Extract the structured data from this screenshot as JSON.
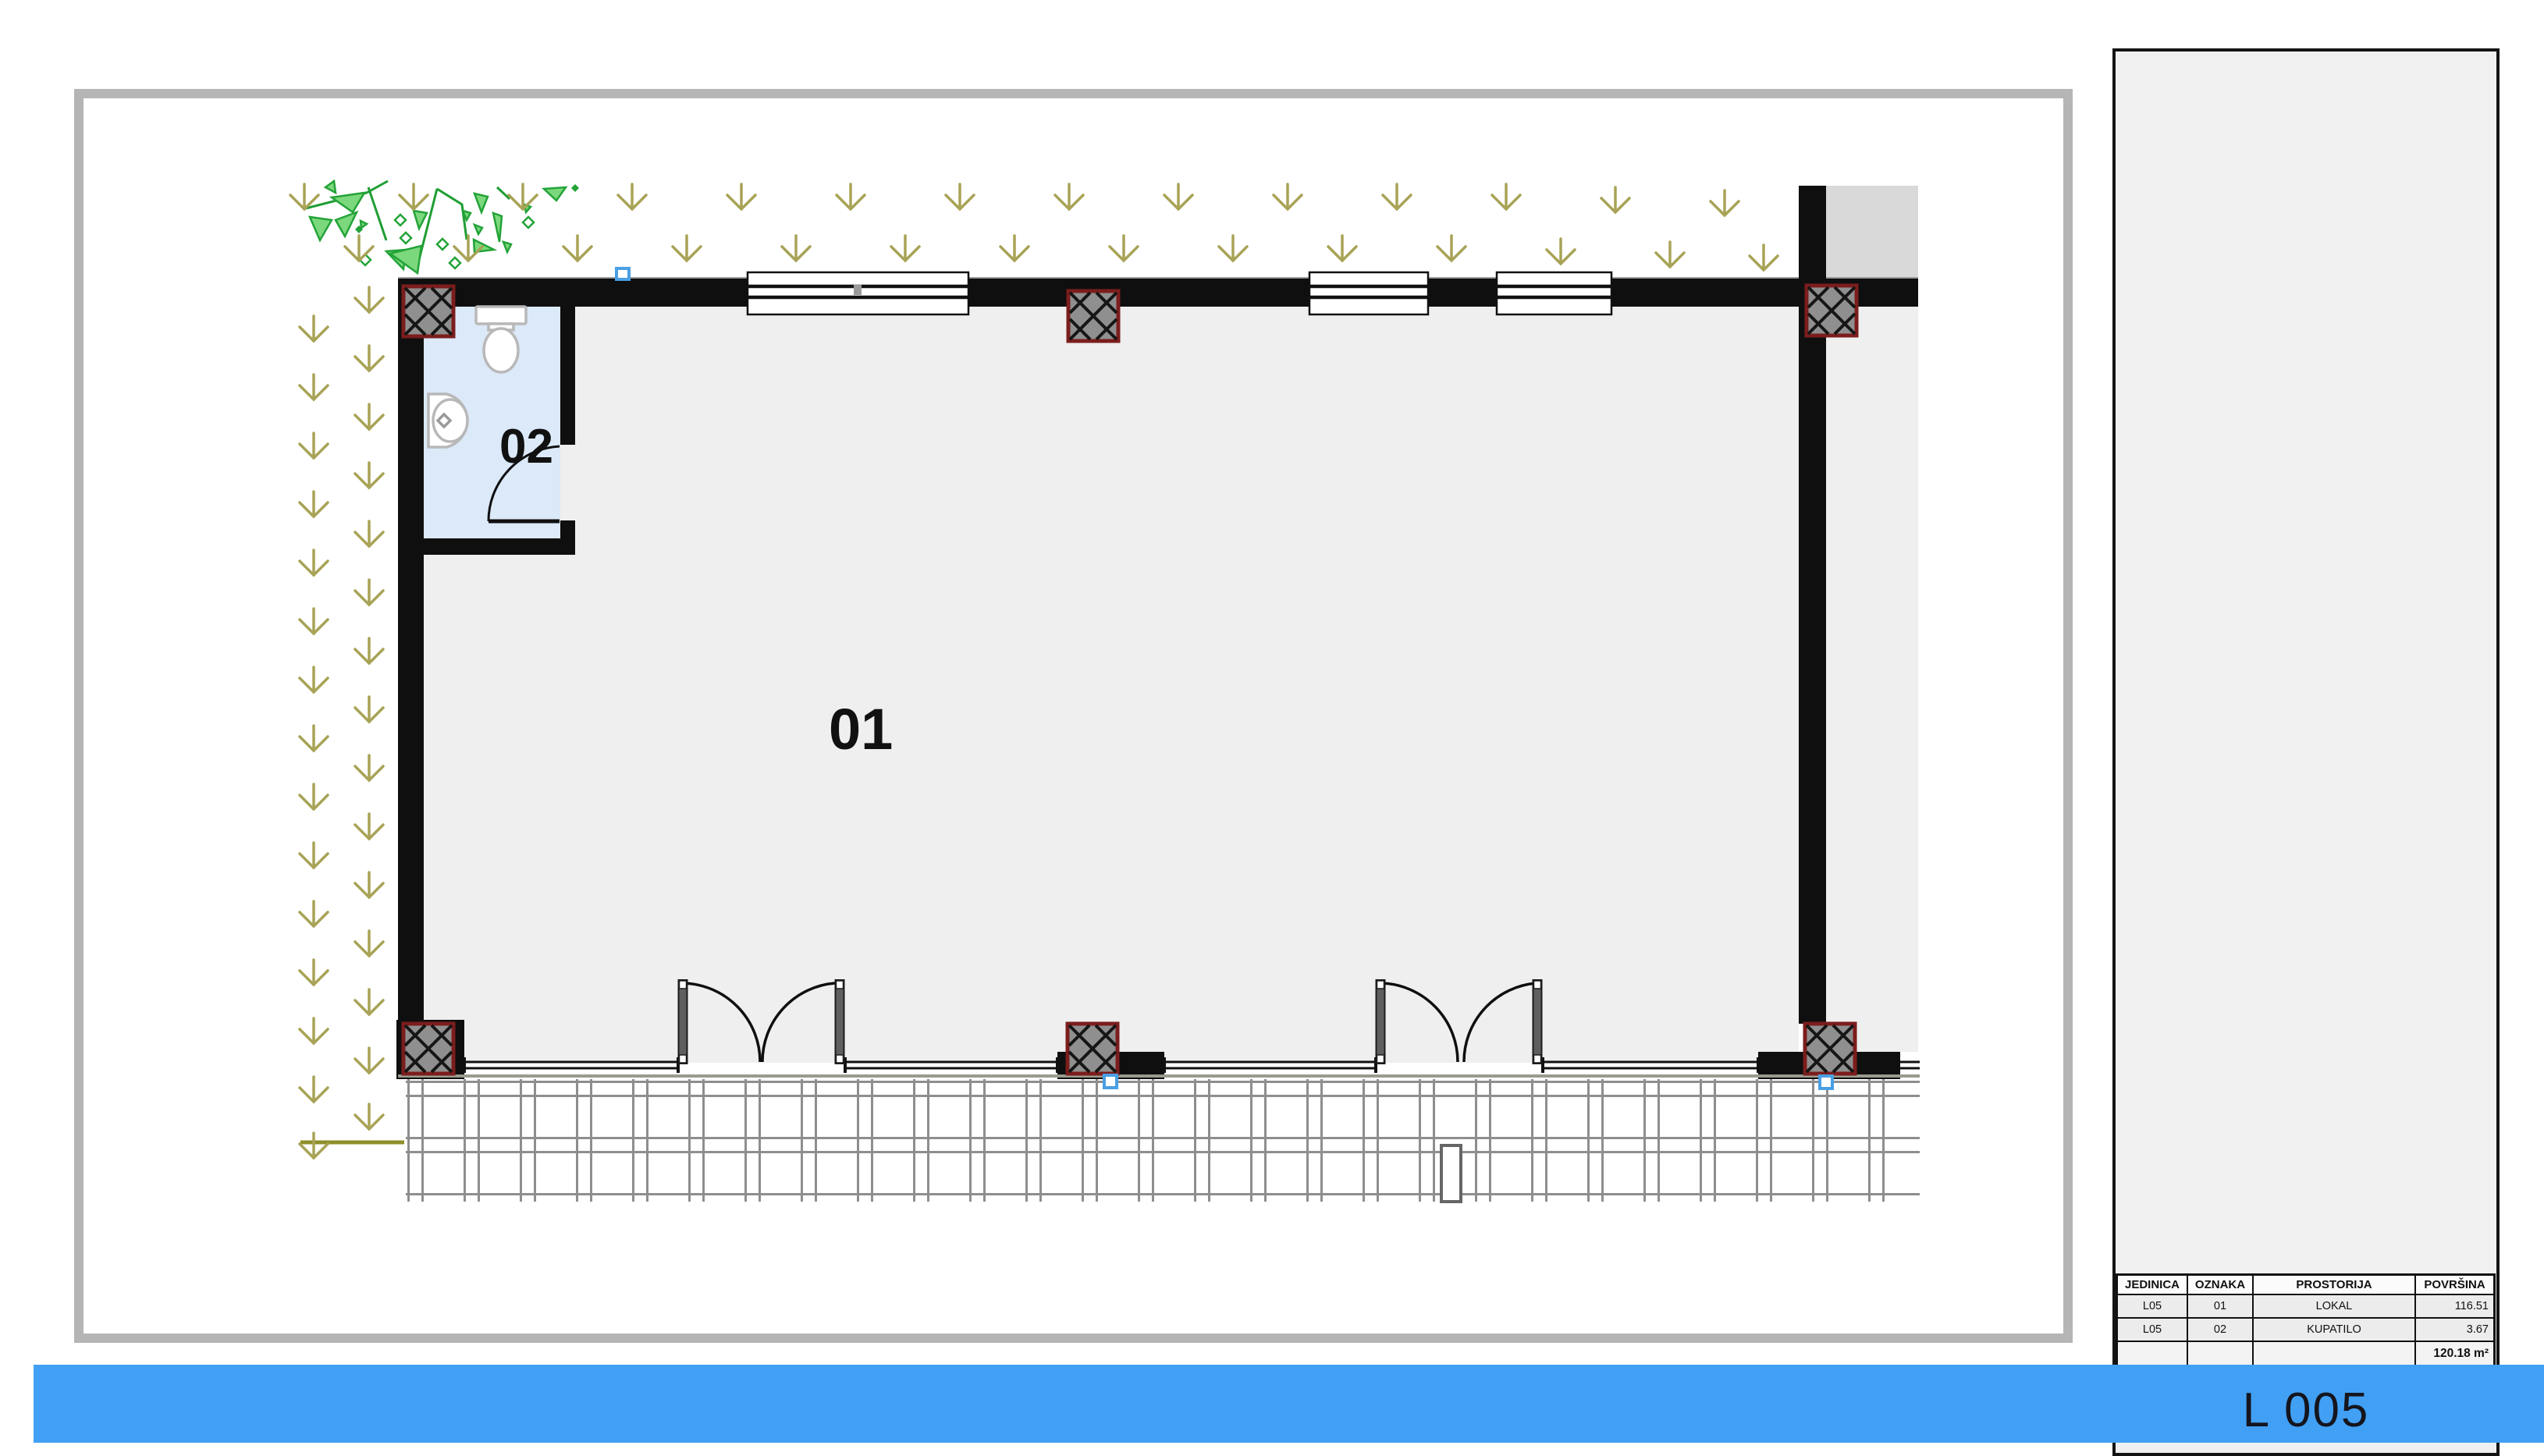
{
  "plan": {
    "rooms": [
      {
        "label": "01",
        "name": "LOKAL"
      },
      {
        "label": "02",
        "name": "KUPATILO"
      }
    ]
  },
  "sidebar": {
    "area_table": {
      "headers": [
        "JEDINICA",
        "OZNAKA",
        "PROSTORIJA",
        "POVRŠINA"
      ],
      "rows": [
        {
          "jedinica": "L05",
          "oznaka": "01",
          "prostorija": "LOKAL",
          "povrsina": "116.51"
        },
        {
          "jedinica": "L05",
          "oznaka": "02",
          "prostorija": "KUPATILO",
          "povrsina": "3.67"
        }
      ],
      "total": "120.18 m²"
    },
    "unit_label": "L 005"
  },
  "colors": {
    "accent_blue": "#41a0f4",
    "frame_gray": "#b5b5b5",
    "wall_black": "#0f0f0f",
    "floor_gray": "#efefef",
    "neighbor_gray": "#d9d9d9",
    "bathroom_blue": "#dbe9f9",
    "column_fill": "#8f8f8f",
    "column_border": "#7c1d1d",
    "plant_green": "#7cd87c",
    "groundcover_olive": "#a8a356",
    "marker_blue": "#4a9fe3"
  }
}
